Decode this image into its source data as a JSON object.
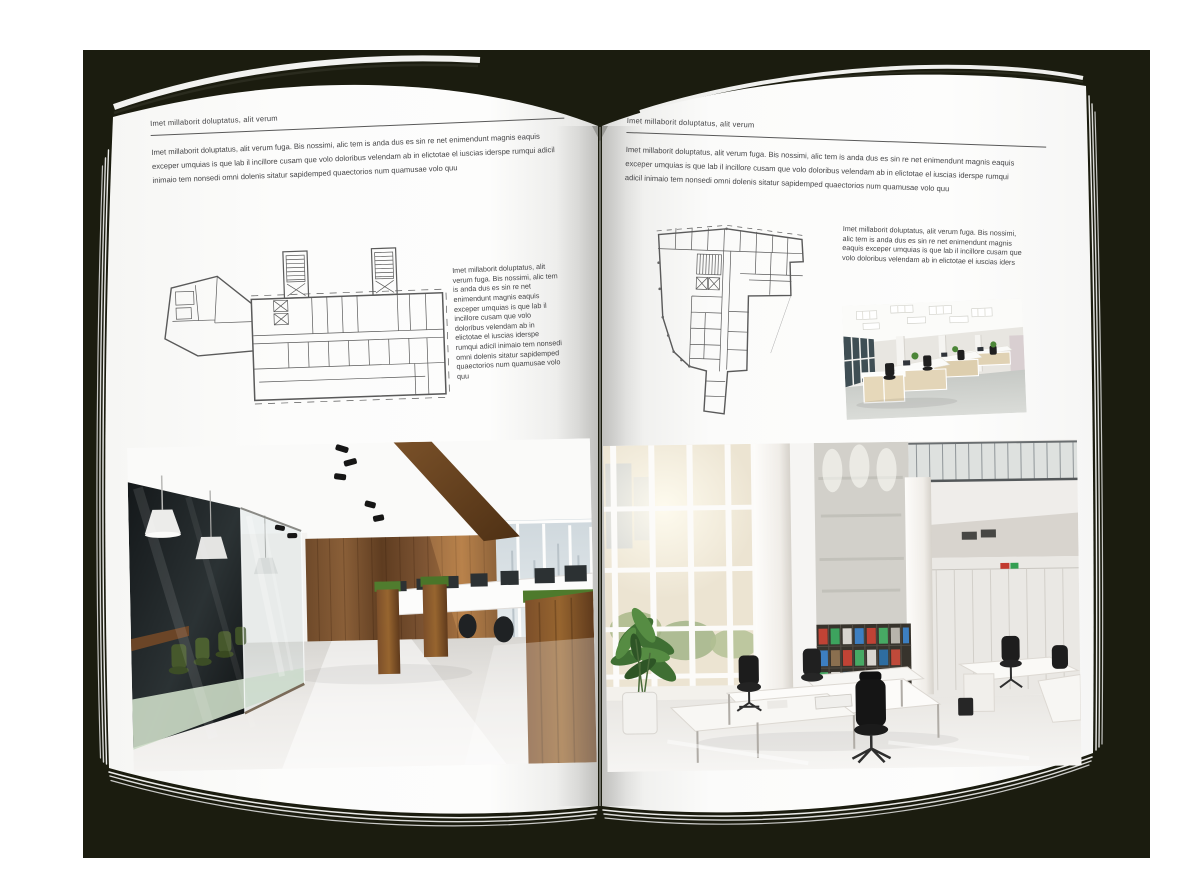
{
  "colors": {
    "backdrop": "#1b1c0f",
    "page": "#fdfdfc",
    "body_text": "#454547",
    "rule": "#595959"
  },
  "left_page": {
    "header": "Imet millaborit doluptatus, alit verum",
    "intro": "Imet millaborit doluptatus, alit verum fuga. Bis nossimi, alic tem is anda dus es sin re net enimendunt magnis eaquis exceper umquias is que lab il incillore cusam que volo doloribus velendam ab in elictotae el iuscias iderspe rumqui adicil inimaio tem nonsedi omni dolenis sitatur sapidemped quaectorios num quamusae volo quu",
    "caption": "Imet millaborit doluptatus, alit verum fuga. Bis nossimi, alic tem is anda dus es sin re net enimendunt magnis eaquis exceper umquias is que lab il incillore cusam que volo doloribus velendam ab in elictotae el iuscias iderspe rumqui adicil inimaio tem nonsedi omni dolenis sitatur sapidemped quaectorios num quamusae volo quu"
  },
  "right_page": {
    "header": "Imet millaborit doluptatus, alit verum",
    "intro": "Imet millaborit doluptatus, alit verum fuga. Bis nossimi, alic tem is anda dus es sin re net enimendunt magnis eaquis exceper umquias is que lab il incillore cusam que volo doloribus velendam ab in elictotae el iuscias iderspe rumqui adicil inimaio tem nonsedi omni dolenis sitatur sapidemped quaectorios num quamusae volo quu",
    "caption": "Imet millaborit doluptatus, alit verum fuga. Bis nossimi, alic tem is anda dus es sin re net enimendunt magnis eaquis exceper umquias is que lab il incillore cusam que volo doloribus velendam ab in elictotae el iuscias iders"
  },
  "images": {
    "left_floorplan": "building-floor-plan-drawing",
    "right_floorplan": "irregular-building-floor-plan-drawing",
    "left_photo": "loft-office-interior-photo",
    "right_photo": "atrium-office-interior-photo",
    "small_photo": "open-plan-office-workstations-photo"
  }
}
